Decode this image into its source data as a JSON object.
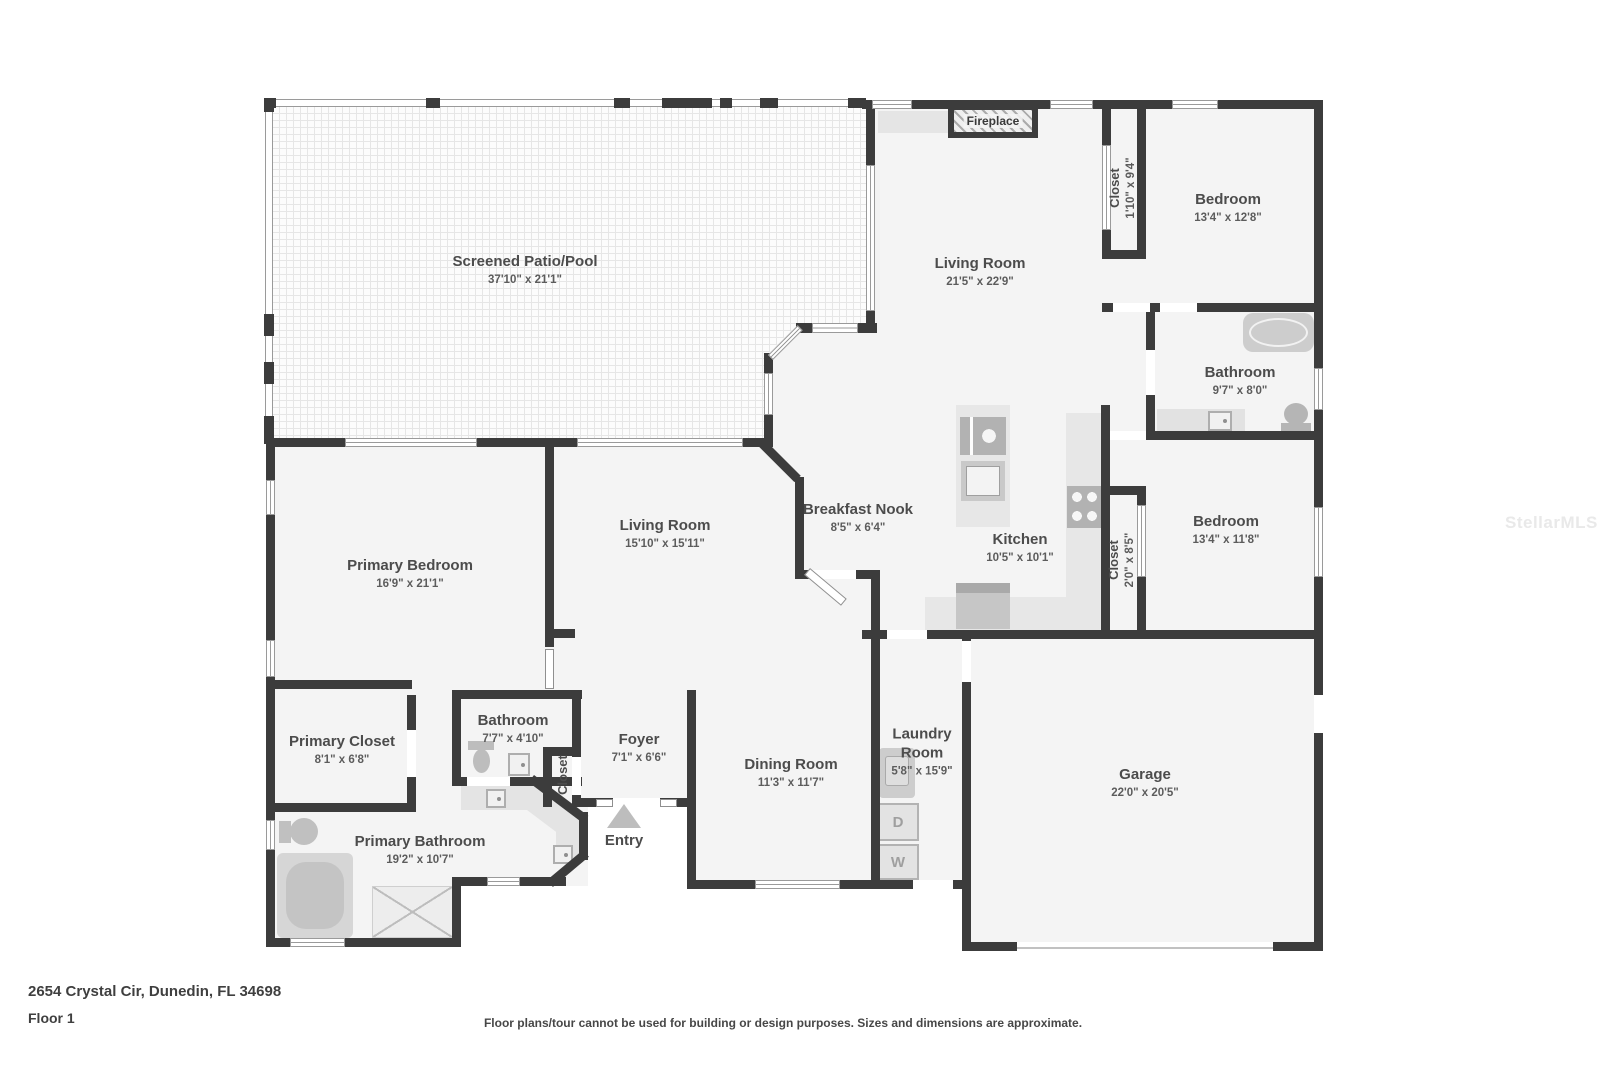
{
  "watermark": "StellarMLS",
  "footer": {
    "address": "2654 Crystal Cir, Dunedin, FL 34698",
    "floor": "Floor 1",
    "disclaimer": "Floor plans/tour cannot be used for building or design purposes. Sizes and dimensions are approximate."
  },
  "colors": {
    "wall": "#3c3c3c",
    "room_fill": "#f4f4f4",
    "fixture": "#c9c9c9",
    "label_text": "#4c4c4c"
  },
  "rooms": {
    "patio": {
      "name": "Screened Patio/Pool",
      "dims": "37'10\" x 21'1\""
    },
    "living_top": {
      "name": "Living Room",
      "dims": "21'5\" x 22'9\""
    },
    "closet_top": {
      "name": "Closet",
      "dims": "1'10\" x 9'4\""
    },
    "bedroom_top": {
      "name": "Bedroom",
      "dims": "13'4\" x 12'8\""
    },
    "bathroom_right": {
      "name": "Bathroom",
      "dims": "9'7\" x 8'0\""
    },
    "bedroom_mid": {
      "name": "Bedroom",
      "dims": "13'4\" x 11'8\""
    },
    "closet_mid": {
      "name": "Closet",
      "dims": "2'0\" x 8'5\""
    },
    "kitchen": {
      "name": "Kitchen",
      "dims": "10'5\" x 10'1\""
    },
    "breakfast_nook": {
      "name": "Breakfast Nook",
      "dims": "8'5\" x 6'4\""
    },
    "living_center": {
      "name": "Living Room",
      "dims": "15'10\" x 15'11\""
    },
    "primary_bedroom": {
      "name": "Primary Bedroom",
      "dims": "16'9\" x 21'1\""
    },
    "primary_closet": {
      "name": "Primary Closet",
      "dims": "8'1\" x 6'8\""
    },
    "bathroom_hall": {
      "name": "Bathroom",
      "dims": "7'7\" x 4'10\""
    },
    "foyer": {
      "name": "Foyer",
      "dims": "7'1\" x 6'6\""
    },
    "hall_closet": {
      "name": "Closet"
    },
    "dining": {
      "name": "Dining Room",
      "dims": "11'3\" x 11'7\""
    },
    "laundry": {
      "name": "Laundry Room",
      "dims": "5'8\" x 15'9\""
    },
    "garage": {
      "name": "Garage",
      "dims": "22'0\" x 20'5\""
    },
    "primary_bathroom": {
      "name": "Primary Bathroom",
      "dims": "19'2\" x 10'7\""
    }
  },
  "annotations": {
    "fireplace": "Fireplace",
    "entry": "Entry",
    "dryer": "D",
    "washer": "W"
  }
}
